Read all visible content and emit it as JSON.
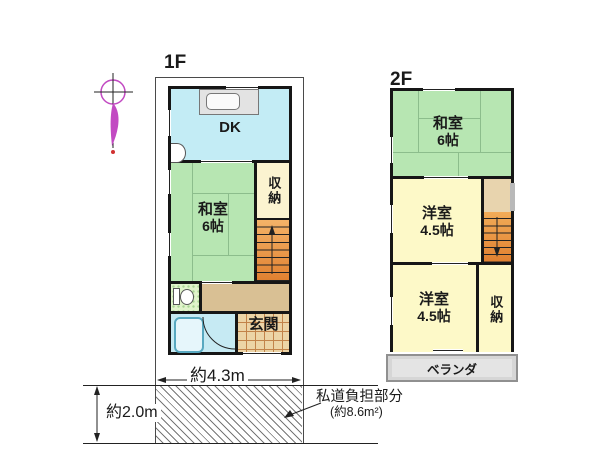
{
  "floors": {
    "f1": {
      "label": "1F",
      "rooms": {
        "dk": {
          "label": "DK"
        },
        "washitsu": {
          "label": "和室",
          "size": "6帖"
        },
        "closet": {
          "label": "収納"
        },
        "genkan": {
          "label": "玄関"
        }
      }
    },
    "f2": {
      "label": "2F",
      "rooms": {
        "washitsu": {
          "label": "和室",
          "size": "6帖"
        },
        "western_mid": {
          "label": "洋室",
          "size": "4.5帖"
        },
        "western_lower": {
          "label": "洋室",
          "size": "4.5帖"
        },
        "closet": {
          "label": "収納"
        },
        "veranda": {
          "label": "ベランダ"
        }
      }
    }
  },
  "dimensions": {
    "frontage": "約4.3m",
    "road_depth": "約2.0m"
  },
  "private_road": {
    "line1": "私道負担部分",
    "line2": "(約8.6m²)"
  },
  "icons": {
    "north_arrow": "north-arrow-icon",
    "kitchen_sink": "kitchen-sink-icon",
    "wash_basin": "wash-basin-icon",
    "toilet": "toilet-icon",
    "bathtub": "bathtub-icon",
    "stairs_up": "stairs-up-arrow-icon",
    "stairs_down": "stairs-down-arrow-icon",
    "door_swing": "door-swing-arc-icon"
  },
  "colors": {
    "wall": "#161616",
    "tatami_room": "#b7e6b2",
    "dk_room": "#c3ecf5",
    "closet_1f": "#fbf3d0",
    "western_room": "#fdf9c8",
    "stairs_orange_top": "#f4b368",
    "stairs_orange_bottom": "#e08030",
    "stairs_landing": "#e8d4ae",
    "hallway": "#d9c094",
    "genkan_tile": "#ecd4a6",
    "bathroom": "#c6eaf3",
    "toilet_room": "#e0f3cb",
    "veranda": "#d6d6d6",
    "north_arrow": "#c24ac2",
    "hatch_line": "#777777"
  }
}
